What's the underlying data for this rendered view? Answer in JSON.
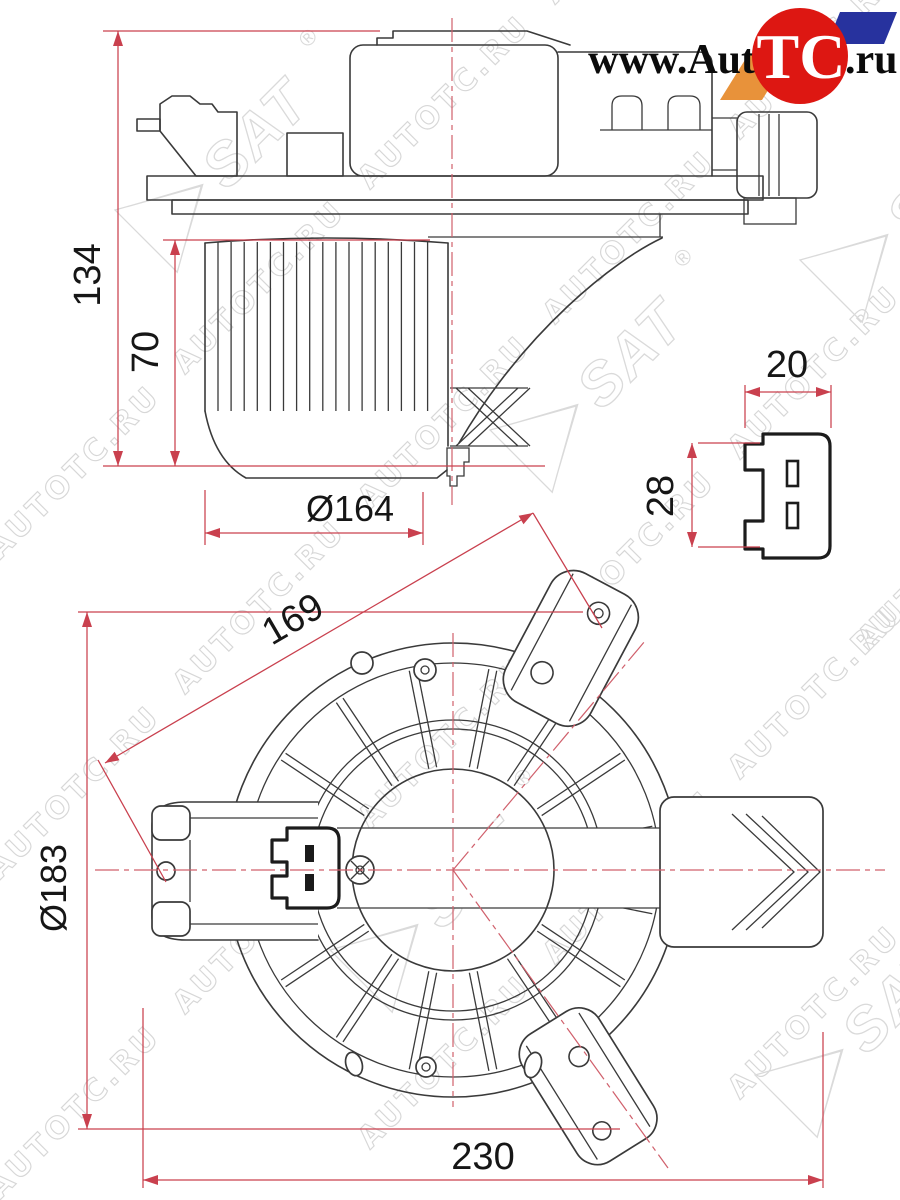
{
  "watermark": {
    "text": "AUTOTC.RU",
    "brand": "SAT",
    "registered": "®"
  },
  "logo": {
    "left": "www.Auto",
    "circle": "TC",
    "right": ".ru",
    "red": "#dd1712",
    "blue": "#27329e",
    "orange": "#e8923a"
  },
  "colors": {
    "dimension_red": "#c9404e",
    "centerline_red": "#d0606c",
    "line": "#3a3a3a",
    "watermark_gray": "#d7d7d7"
  },
  "views": {
    "side_view": {
      "dims": {
        "overall_height": "134",
        "cage_height": "70",
        "cage_diameter": "Ø164"
      }
    },
    "connector_detail": {
      "dims": {
        "width": "20",
        "height": "28"
      }
    },
    "bottom_view": {
      "dims": {
        "hole_distance": "169",
        "flange_diameter": "Ø183",
        "overall_width": "230"
      }
    }
  }
}
